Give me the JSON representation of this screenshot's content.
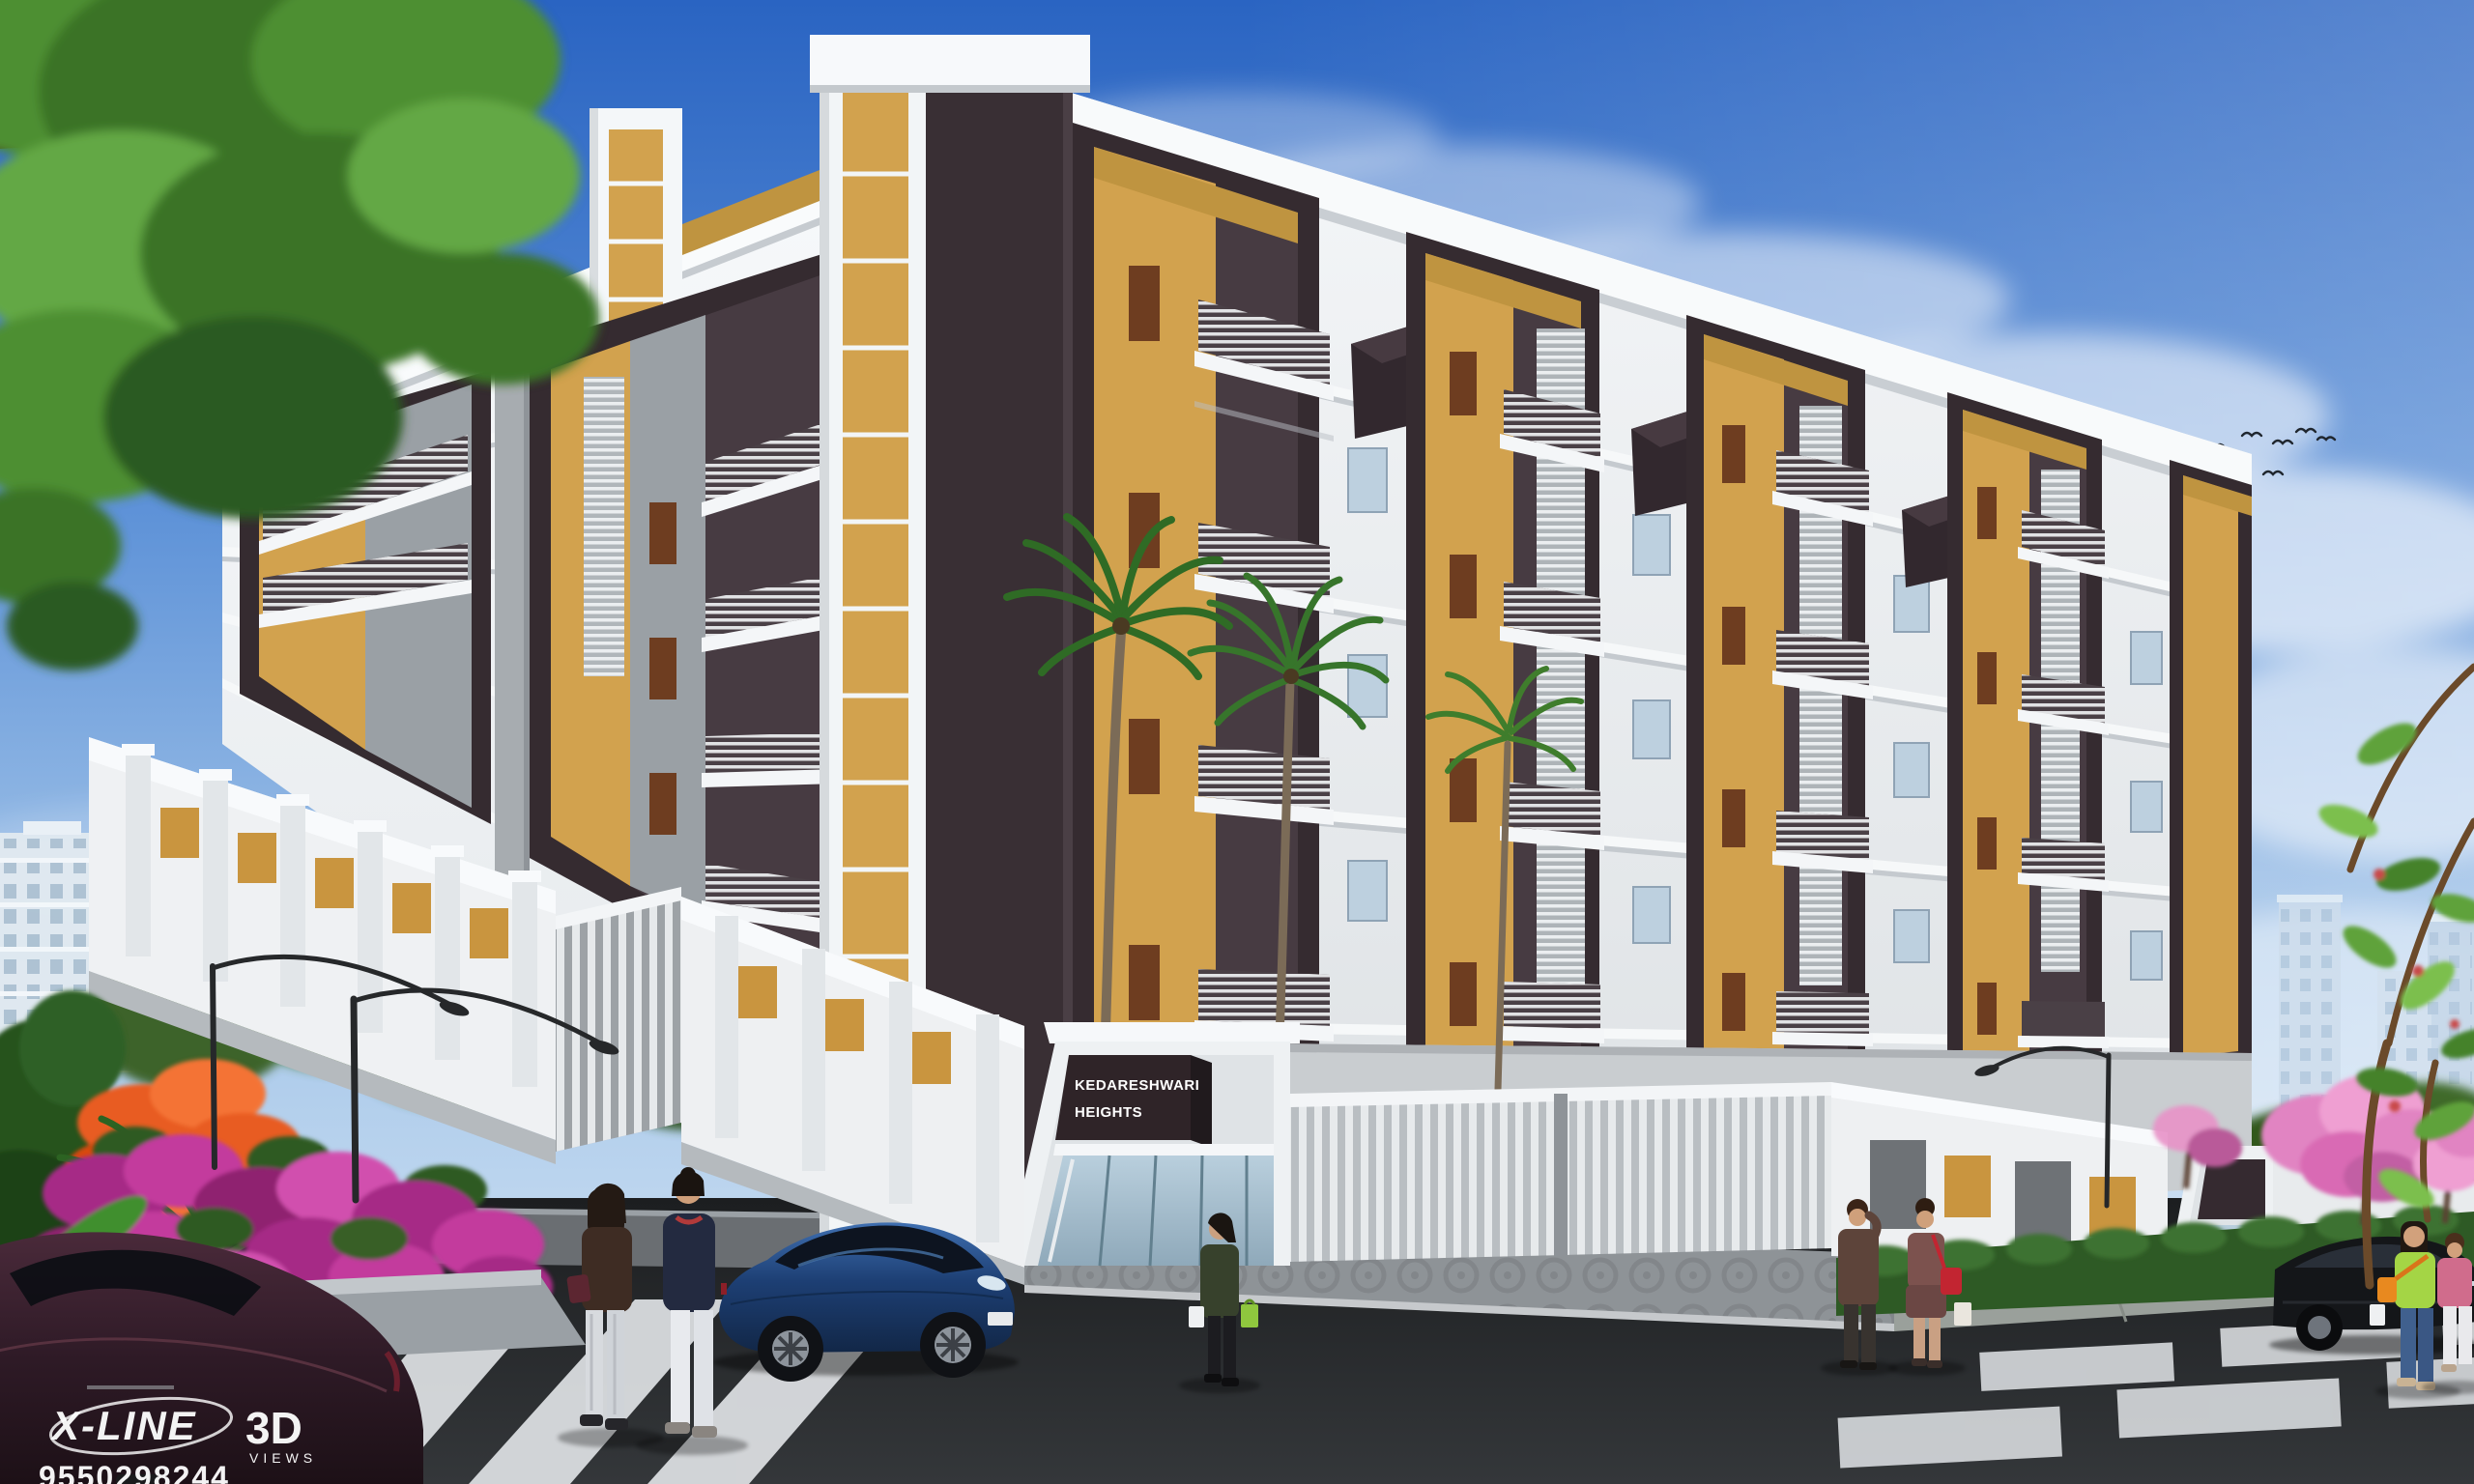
{
  "entrance_sign": {
    "line1": "KEDARESHWARI",
    "line2": "HEIGHTS"
  },
  "watermark": {
    "brand": "X-LINE",
    "suffix": "3D",
    "tagline": "VIEWS",
    "phone": "9550298244"
  },
  "palette": {
    "sky_top": "#2a64c2",
    "sky_horizon": "#d9e8f5",
    "facade_white": "#f1f4f6",
    "accent_mustard": "#d2a24e",
    "accent_dark_brown": "#352b30",
    "concrete_grey": "#9aa0a5",
    "road_asphalt": "#26282b",
    "bougainvillea_magenta": "#c33b9d",
    "foliage_green": "#4d8f33",
    "pink_blossom": "#e184c2",
    "car_blue": "#1d3f74"
  }
}
